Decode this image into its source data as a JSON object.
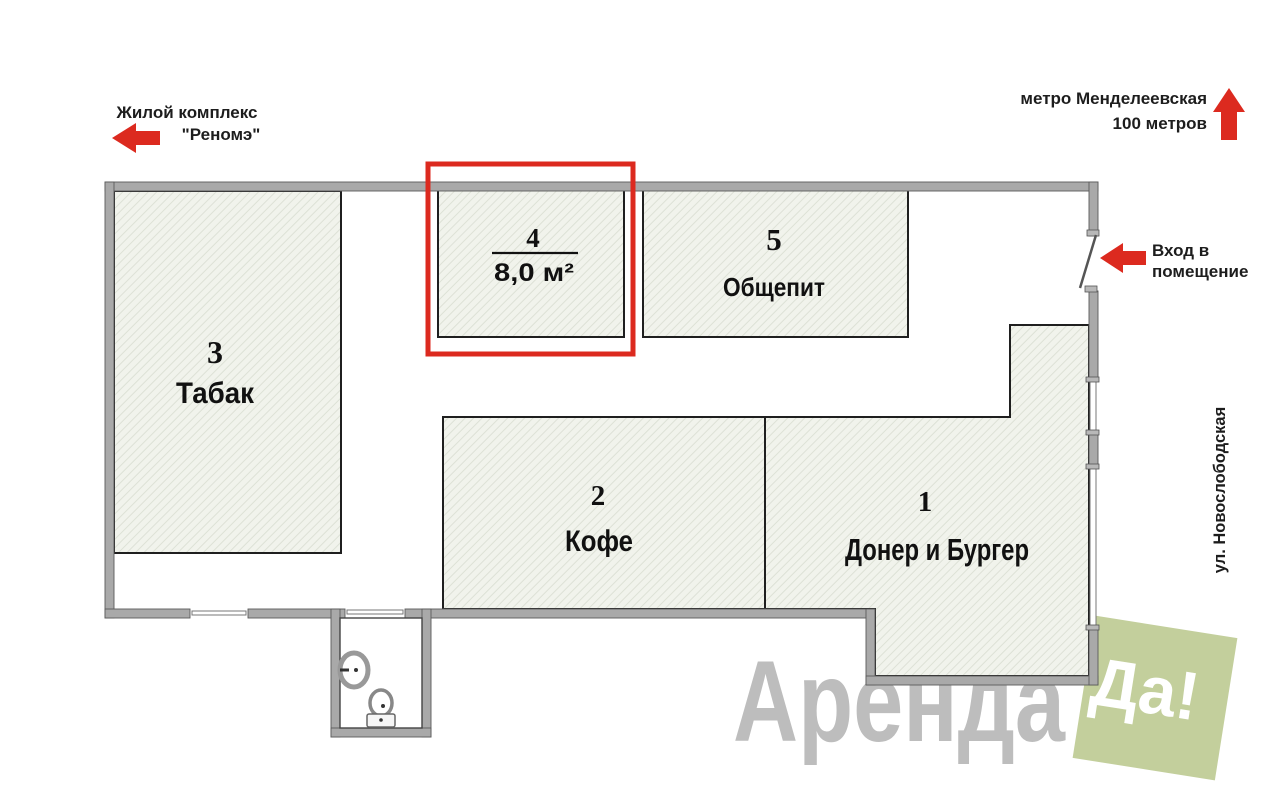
{
  "title": "Floor plan of retail premises",
  "annotations": {
    "residential_complex": {
      "line1": "Жилой комплекс",
      "line2": "\"Реномэ\"",
      "icon": "arrow-left"
    },
    "metro": {
      "line1": "метро Менделеевская",
      "line2": "100 метров",
      "icon": "arrow-up"
    },
    "entrance": {
      "line1": "Вход в",
      "line2": "помещение",
      "icon": "arrow-left"
    },
    "street": {
      "label": "ул. Новослободская"
    }
  },
  "rooms": {
    "r1": {
      "number": "1",
      "name": "Донер и Бургер"
    },
    "r2": {
      "number": "2",
      "name": "Кофе"
    },
    "r3": {
      "number": "3",
      "name": "Табак"
    },
    "r4": {
      "number": "4",
      "area": "8,0 м²",
      "highlighted": true
    },
    "r5": {
      "number": "5",
      "name": "Общепит"
    }
  },
  "features": {
    "bathroom": {
      "fixtures": [
        "sink",
        "toilet"
      ]
    }
  },
  "watermark": {
    "brand": "Аренда",
    "badge": "Да!"
  },
  "colors": {
    "accent_red": "#dc2a1f",
    "wall_gray": "#a9a9a9",
    "wall_outline": "#5a5a5a",
    "room_border": "#1f1f1f",
    "hatch_bg": "#f1f3ec",
    "hatch_line": "#dde1d6",
    "watermark_gray": "#bdbdbd",
    "badge_green": "#c3cf9c",
    "badge_text": "#ffffff",
    "label_color": "#111111"
  }
}
